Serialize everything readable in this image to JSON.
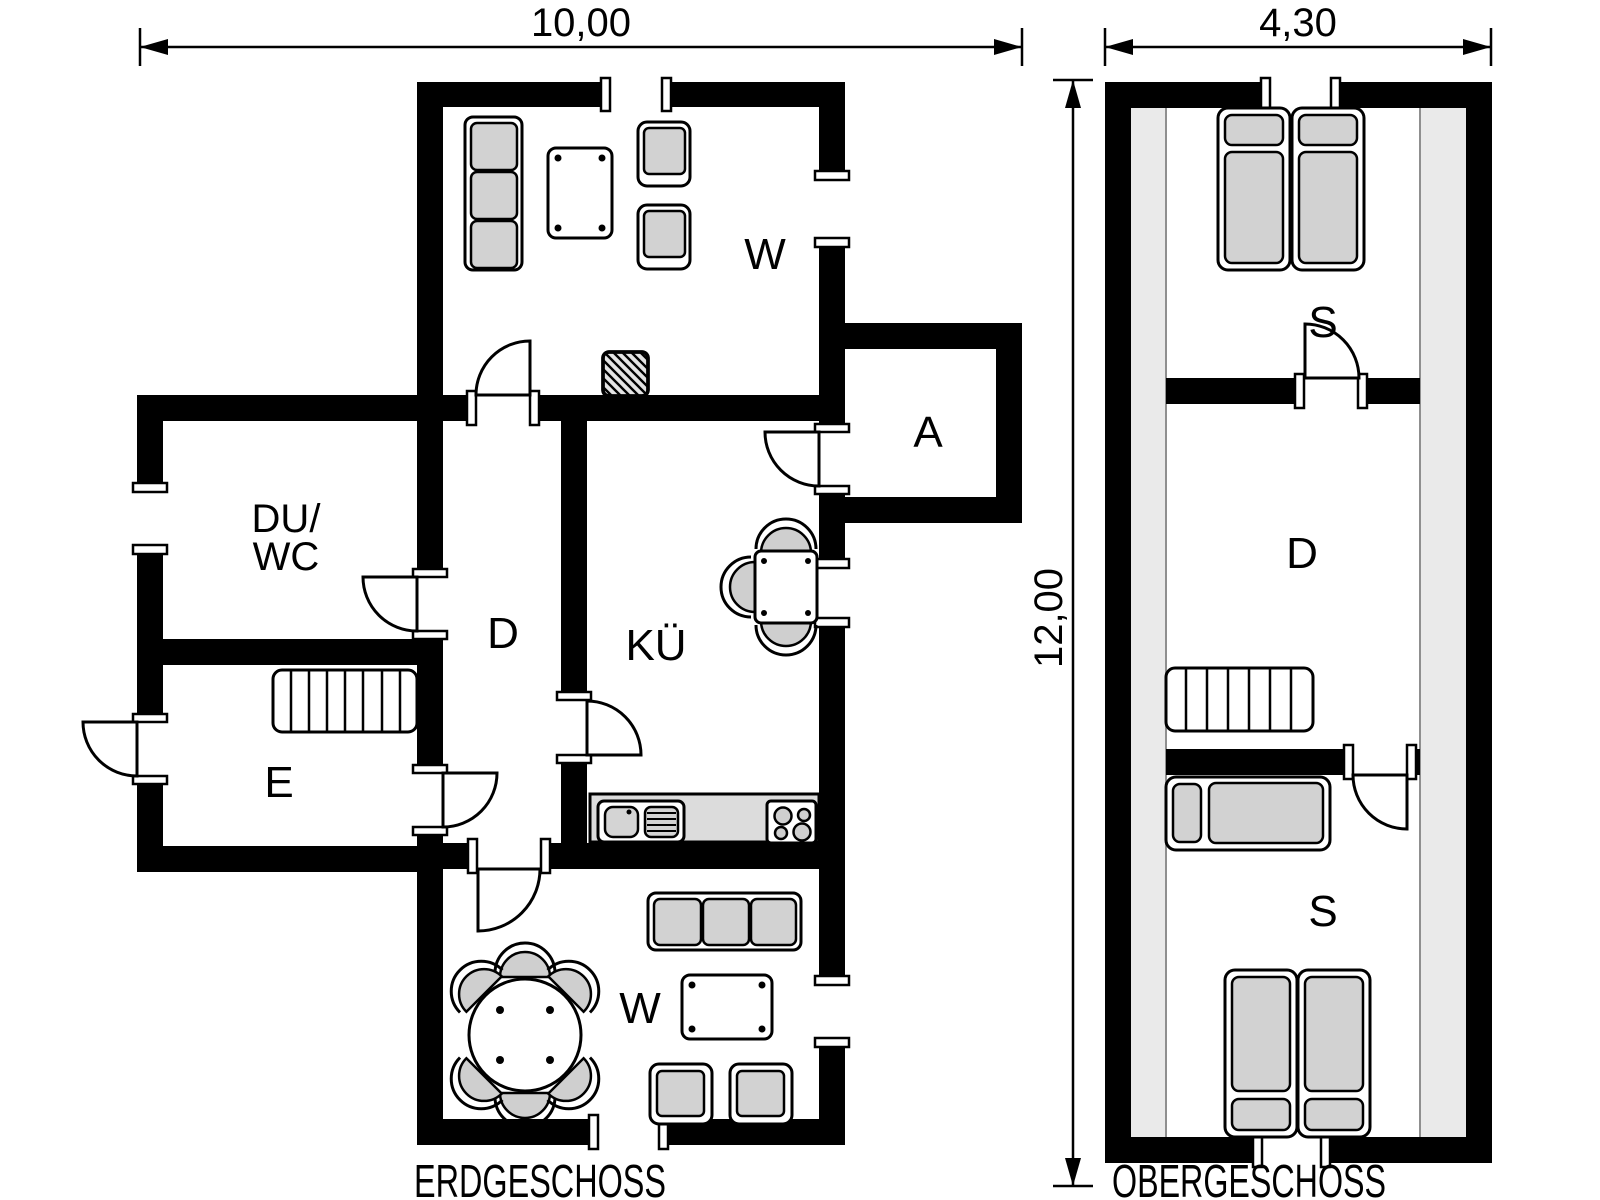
{
  "drawing": {
    "type": "architectural-floor-plan",
    "units": "meters"
  },
  "dimensions": {
    "ground_floor_width": "10,00",
    "upper_floor_width": "4,30",
    "building_depth": "12,00"
  },
  "ground_floor": {
    "caption": "ERDGESCHOSS",
    "rooms": {
      "living_room_top": "W",
      "storage": "A",
      "shower_wc_line1": "DU/",
      "shower_wc_line2": "WC",
      "hallway": "D",
      "kitchen": "KÜ",
      "entrance": "E",
      "living_room_bottom": "W"
    },
    "furniture_icons": [
      "sofa-3-seat-icon",
      "coffee-table-icon",
      "armchair-icon",
      "armchair-icon",
      "fireplace-stove-icon",
      "dining-table-square-icon",
      "chair-icon",
      "kitchen-counter-icon",
      "sink-icon",
      "stove-4-burner-icon",
      "stairs-icon",
      "round-table-icon",
      "chair-icon",
      "sofa-3-seat-icon",
      "table-icon",
      "armchair-icon"
    ]
  },
  "upper_floor": {
    "caption": "OBERGESCHOSS",
    "rooms": {
      "bedroom_top": "S",
      "landing": "D",
      "bedroom_bottom": "S"
    },
    "furniture_icons": [
      "double-bed-icon",
      "stairs-icon",
      "single-bed-icon",
      "double-bed-icon"
    ]
  },
  "colors": {
    "wall": "#000000",
    "background": "#ffffff",
    "furniture_fill": "#d2d2d2",
    "counter_fill": "#dcdcdc",
    "attic_slope_strip": "#eaeaea"
  }
}
